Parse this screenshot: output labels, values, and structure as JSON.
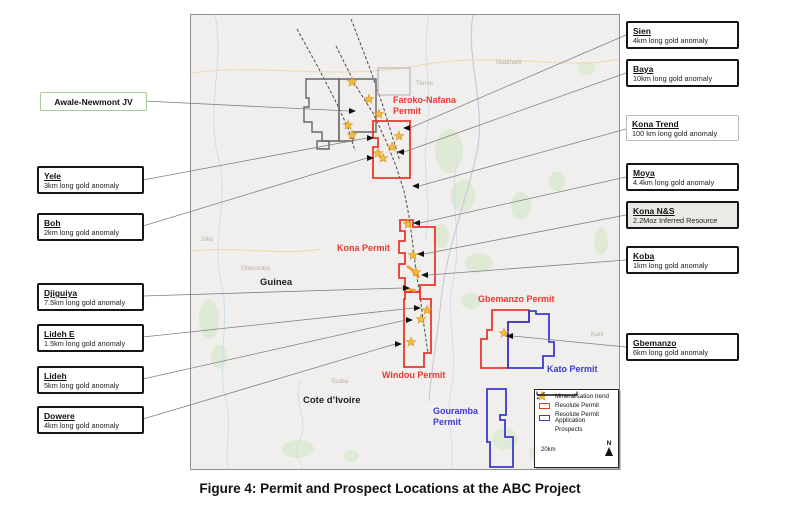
{
  "figure": {
    "caption": "Figure 4: Permit and Prospect Locations at the ABC Project"
  },
  "colors": {
    "resolute_permit": "#e8392e",
    "permit_application": "#3b3bcf",
    "prospect_star": "#f6bb3f",
    "resource_outline": "#f39c1f",
    "jv_boundary": "#666666",
    "awale_box_border": "#a9cb8d",
    "callout_border": "#151515"
  },
  "callouts_left": [
    {
      "id": "awale-newmont-jv",
      "title": "Awale-Newmont JV",
      "subtitle": ""
    },
    {
      "id": "yele",
      "title": "Yele",
      "subtitle": "3km long gold anomaly"
    },
    {
      "id": "boh",
      "title": "Boh",
      "subtitle": "2km long gold anomaly"
    },
    {
      "id": "djiguiya",
      "title": "Djiguiya",
      "subtitle": "7.5km long gold anomaly"
    },
    {
      "id": "lideh-e",
      "title": "Lideh E",
      "subtitle": "1.5km long gold anomaly"
    },
    {
      "id": "lideh",
      "title": "Lideh",
      "subtitle": "5km long gold anomaly"
    },
    {
      "id": "dowere",
      "title": "Dowere",
      "subtitle": "4km long gold anomaly"
    }
  ],
  "callouts_right": [
    {
      "id": "sien",
      "title": "Sien",
      "subtitle": "4km long gold anomaly"
    },
    {
      "id": "baya",
      "title": "Baya",
      "subtitle": "10km long gold anomaly"
    },
    {
      "id": "kona-trend",
      "title": "Kona Trend",
      "subtitle": "100 km long gold anomaly"
    },
    {
      "id": "moya",
      "title": "Moya",
      "subtitle": "4.4km long gold anomaly"
    },
    {
      "id": "kona-ns",
      "title": "Kona N&S",
      "subtitle": "2.2Moz Inferred Resource"
    },
    {
      "id": "koba",
      "title": "Koba",
      "subtitle": "1km long gold anomaly"
    },
    {
      "id": "gbemanzo",
      "title": "Gbemanzo",
      "subtitle": "6km long gold anomaly"
    }
  ],
  "map": {
    "permits": {
      "faroko": {
        "line1": "Faroko-Nafana",
        "line2": "Permit"
      },
      "kona": {
        "label": "Kona Permit"
      },
      "gbemanzo": {
        "label": "Gbemanzo Permit"
      },
      "windou": {
        "label": "Windou Permit"
      },
      "kato": {
        "label": "Kato Permit"
      },
      "gouramba": {
        "line1": "Gouramba",
        "line2": "Permit"
      }
    },
    "countries": {
      "guinea": "Guinea",
      "cote_divoire": "Cote d’Ivoire"
    },
    "places": [
      "Tieme",
      "Madinani",
      "Siko",
      "Gbessoba",
      "Kani",
      "Touba",
      "Sifie"
    ]
  },
  "legend": {
    "items": [
      "Mineralisation trend",
      "Resolute Permit",
      "Resolute Permit Application",
      "Prospects"
    ],
    "scale_label": "20km",
    "north_label": "N"
  }
}
